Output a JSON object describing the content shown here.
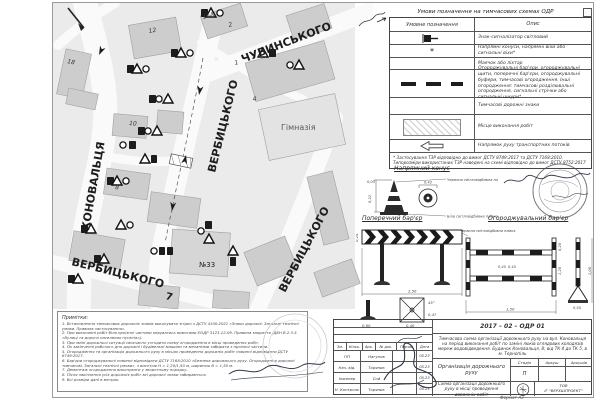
{
  "sheet": {
    "format_label": "Формат А3"
  },
  "map": {
    "labels": {
      "konovaltsia": "КОНОВАЛЬЦЯ",
      "chubynskoho": "ЧУБИНСЬКОГО",
      "verbytskoho_center": "ВЕРБИЦЬКОГО",
      "verbytskoho_right": "ВЕРБИЦЬКОГО",
      "verbytskoho_bottom": "ВЕРБИЦЬКОГО",
      "himnaziia": "Гімназія",
      "building_33": "№33",
      "house_7": "7"
    },
    "house_numbers": {
      "h18": "18",
      "h12": "12",
      "h16a": "16А",
      "h2": "2",
      "h1": "1",
      "h4": "4",
      "h10": "10",
      "h8": "8"
    }
  },
  "legend": {
    "title": "Умови позначення на тимчасових схемах ОДР",
    "col_symbol": "Умовне позначення",
    "col_desc": "Опис",
    "star_symbol": "*",
    "rows": [
      {
        "desc": "Знак-сигналізатор світловий"
      },
      {
        "desc": "Напрямні конуси, напрямні віхи або сигнальні віхи*"
      },
      {
        "desc": "Маячок або ліхтар"
      },
      {
        "desc": "Огороджувальні бар'єри, огороджувальні щити, поперечні бар'єри, огороджувальні буфери, тимчасові огородження. Інші огородження: тимчасові розділювальні огородження, сигнальні стрічки або сигнальні шнури*"
      },
      {
        "desc": "Тимчасові дорожні знаки"
      },
      {
        "desc": "Місце виконання робіт"
      },
      {
        "desc": "Напрямок руху транспортних потоків"
      }
    ],
    "footnote": "* Застосування ТЗР відповідно до вимог ДСТУ 8749:2017 та ДСТУ 7168:2010. Типорозміри використаних ТЗР наведені на схемі відповідно до вимог ДСТУ 8752:2017"
  },
  "drawings": {
    "cone": {
      "title": "Напрямний конус",
      "label_red": "Червона світловідбивна плівка",
      "label_white": "Біла світловідбивна плівка",
      "dim_top": "0,05",
      "dim_height": "0,32",
      "dim_base": "0,42"
    },
    "transverse": {
      "title": "Поперечний бар'єр",
      "dim_width": "2,50",
      "dim_panel": "0,25",
      "dim_plate": "0,40",
      "dim_plate2": "0,47",
      "dim_angle": "45°",
      "dim_foot": "0,60"
    },
    "fencing": {
      "title": "Огороджувальний бар'єр",
      "label_film": "Червона світловідбивна плівка",
      "dim_width": "1,50",
      "dim_seg1": "0,45",
      "dim_seg2": "0,45",
      "dim_rail": "0,20",
      "dim_height": "1,20",
      "dim_stand": "1,00",
      "dim_base": "0,50"
    }
  },
  "notes": {
    "title": "Примітки:",
    "lines": [
      "1. Встановлення тимчасових дорожніх знаків виконувати згідно з ДСТУ 4100:2021 «Знаки дорожні. Загальні технічні умови. Правила застосування».",
      "2. При виконанні робіт біля проїзної частини керуватись вимогами ЄОДР 3123-12-09. Правила закриття (ДБН В.2.3-5 «Вулиці та дороги населених пунктів»).",
      "3. При зміні дорожньої ситуації своєчасно узгодити схему огородження в місці проведення робіт.",
      "4. По закінченні робочого дня дорожні і будівельні машини та механізми забирати з проїзної частини.",
      "5. Огородження та організація дорожнього руху в місцях проведення дорожніх робіт повинні відповідати ДСТУ 8749:2017.",
      "6. Бар'єри огороджувальні повинні відповідати ДСТУ 7168:2010 «Безпека дорожнього руху. Огородження дорожні тимчасові. Загальні технічні умови», з висотою Н = 1,20/1,50 м, шириною В = 1,50 м.",
      "7. Демонтаж огородження виконувати у зворотному порядку.",
      "8. Після закінчення усіх дорожніх робіт всі дорожні знаки забираються.",
      "9. Всі розміри дані в метрах."
    ]
  },
  "titleblock": {
    "doc_number": "2017 – 02 – ОДР 01",
    "description": "Тимчасова схема організації дорожнього руху на вул. Коновальця на період виконання робіт по заміні люків оглядових колодязів мереж водовідведення. Будинок Коновальця, 8; від ТК 4 до ТК 5, в м. Тернопіль",
    "columns": [
      "Зм.",
      "Кільк.",
      "Арк.",
      "№ док.",
      "Підпис",
      "Дата"
    ],
    "rows": [
      {
        "role": "ГІП",
        "name": "Нагулов",
        "date": "05.23"
      },
      {
        "role": "Нач. від.",
        "name": "Торяник",
        "date": "05.23"
      },
      {
        "role": "Інженер",
        "name": "Сой",
        "date": "05.23"
      },
      {
        "role": "Н. Контроль",
        "name": "Торяник",
        "date": "05.23"
      }
    ],
    "org_label": "Організація дорожнього руху",
    "stage_headers": [
      "Стадія",
      "Аркуш",
      "Аркушів"
    ],
    "stage_value": "П",
    "scheme_label": "Схема організації дорожнього руху в місці проведення дорожніх робіт",
    "company_line1": "ТОВ",
    "company_line2": "ІГ \"ВЕРХШПРОЕКТ\""
  }
}
